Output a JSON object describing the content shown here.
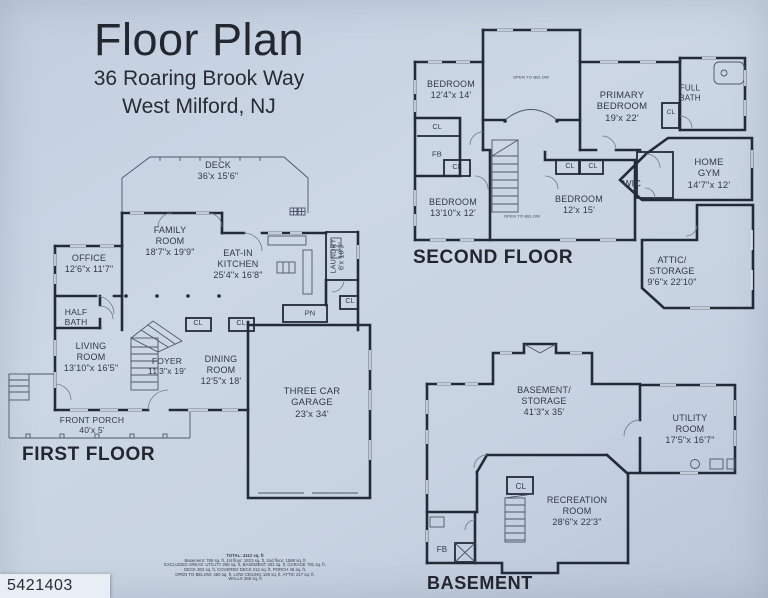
{
  "colors": {
    "paper": "#c8d3e2",
    "wall": "#232a39",
    "ink": "#313848",
    "id_strip_bg": "#e9edf4"
  },
  "title": {
    "main": "Floor Plan",
    "address_line1": "36 Roaring Brook Way",
    "address_line2": "West Milford, NJ"
  },
  "photo_id": "5421403",
  "floors": {
    "first": {
      "heading": "FIRST FLOOR",
      "labels": [
        {
          "t": "DECK\n36'x 15'6\"",
          "x": 218,
          "y": 171,
          "fs": 9
        },
        {
          "t": "FAMILY\nROOM\n18'7\"x 19'9\"",
          "x": 170,
          "y": 241,
          "fs": 9
        },
        {
          "t": "OFFICE\n12'6\"x 11'7\"",
          "x": 89,
          "y": 264,
          "fs": 9
        },
        {
          "t": "EAT-IN\nKITCHEN\n25'4\"x 16'8\"",
          "x": 238,
          "y": 264,
          "fs": 9
        },
        {
          "t": "LAUNDRY\n6'x 10'9\"",
          "x": 339,
          "y": 256,
          "fs": 7,
          "rot": -90
        },
        {
          "t": "CL",
          "x": 350,
          "y": 302,
          "fs": 7
        },
        {
          "t": "PN",
          "x": 310,
          "y": 313,
          "fs": 7.5
        },
        {
          "t": "HALF\nBATH",
          "x": 76,
          "y": 317,
          "fs": 8.5
        },
        {
          "t": "LIVING\nROOM\n13'10\"x 16'5\"",
          "x": 91,
          "y": 357,
          "fs": 9
        },
        {
          "t": "FOYER\n11'3\"x 19'",
          "x": 167,
          "y": 366,
          "fs": 8.5
        },
        {
          "t": "CL",
          "x": 198,
          "y": 324,
          "fs": 7
        },
        {
          "t": "CL",
          "x": 241,
          "y": 324,
          "fs": 7
        },
        {
          "t": "DINING\nROOM\n12'5\"x 18'",
          "x": 221,
          "y": 370,
          "fs": 9
        },
        {
          "t": "THREE CAR\nGARAGE\n23'x 34'",
          "x": 312,
          "y": 403,
          "fs": 9.5
        },
        {
          "t": "FRONT PORCH\n40'x 5'",
          "x": 92,
          "y": 425,
          "fs": 8.5
        }
      ]
    },
    "second": {
      "heading": "SECOND FLOOR",
      "labels": [
        {
          "t": "BEDROOM\n12'4\"x 14'",
          "x": 451,
          "y": 90,
          "fs": 9
        },
        {
          "t": "OPEN TO BELOW",
          "x": 531,
          "y": 78,
          "fs": 4
        },
        {
          "t": "PRIMARY\nBEDROOM\n19'x 22'",
          "x": 622,
          "y": 107,
          "fs": 9.5
        },
        {
          "t": "FULL\nBATH",
          "x": 690,
          "y": 93,
          "fs": 8
        },
        {
          "t": "CL",
          "x": 671,
          "y": 113,
          "fs": 6.5
        },
        {
          "t": "HOME\nGYM\n14'7\"x 12'",
          "x": 709,
          "y": 174,
          "fs": 9.5
        },
        {
          "t": "WIC",
          "x": 632,
          "y": 184,
          "fs": 9
        },
        {
          "t": "CL",
          "x": 570,
          "y": 167,
          "fs": 7
        },
        {
          "t": "CL",
          "x": 593,
          "y": 167,
          "fs": 7
        },
        {
          "t": "BEDROOM\n12'x 15'",
          "x": 579,
          "y": 205,
          "fs": 9
        },
        {
          "t": "CL",
          "x": 437,
          "y": 128,
          "fs": 7
        },
        {
          "t": "FB",
          "x": 437,
          "y": 154,
          "fs": 7.5
        },
        {
          "t": "CL",
          "x": 457,
          "y": 168,
          "fs": 7
        },
        {
          "t": "BEDROOM\n13'10\"x 12'",
          "x": 453,
          "y": 208,
          "fs": 9
        },
        {
          "t": "OPEN TO BELOW",
          "x": 522,
          "y": 217,
          "fs": 4
        },
        {
          "t": "ATTIC/\nSTORAGE\n9'6\"x 22'10\"",
          "x": 672,
          "y": 271,
          "fs": 9
        }
      ]
    },
    "basement": {
      "heading": "BASEMENT",
      "labels": [
        {
          "t": "BASEMENT/\nSTORAGE\n41'3\"x 35'",
          "x": 544,
          "y": 401,
          "fs": 9
        },
        {
          "t": "UTILITY\nROOM\n17'5\"x 16'7\"",
          "x": 690,
          "y": 429,
          "fs": 9
        },
        {
          "t": "CL",
          "x": 521,
          "y": 487,
          "fs": 8
        },
        {
          "t": "RECREATION\nROOM\n28'6\"x 22'3\"",
          "x": 577,
          "y": 511,
          "fs": 9
        },
        {
          "t": "FB",
          "x": 442,
          "y": 550,
          "fs": 8
        }
      ]
    }
  },
  "area_summary": {
    "line1": "TOTAL: 4112 sq. ft",
    "line2": "Basement: 786 sq. ft, 1st floor: 1823 sq. ft, 2nd floor: 1588 sq. ft",
    "line3": "EXCLUDED AREAS: UTILITY 298 sq. ft, BASEMENT 403 sq. ft, GARAGE 781 sq. ft,",
    "line4": "DECK 302 sq. ft, COVERED DECK 212 sq. ft, PORCH 46 sq. ft,",
    "line5": "OPEN TO BELOW: 450 sq. ft, LOW CEILING 129 sq. ft, ATTIC 217 sq. ft,",
    "line6": "WALLS 369 sq. ft"
  }
}
